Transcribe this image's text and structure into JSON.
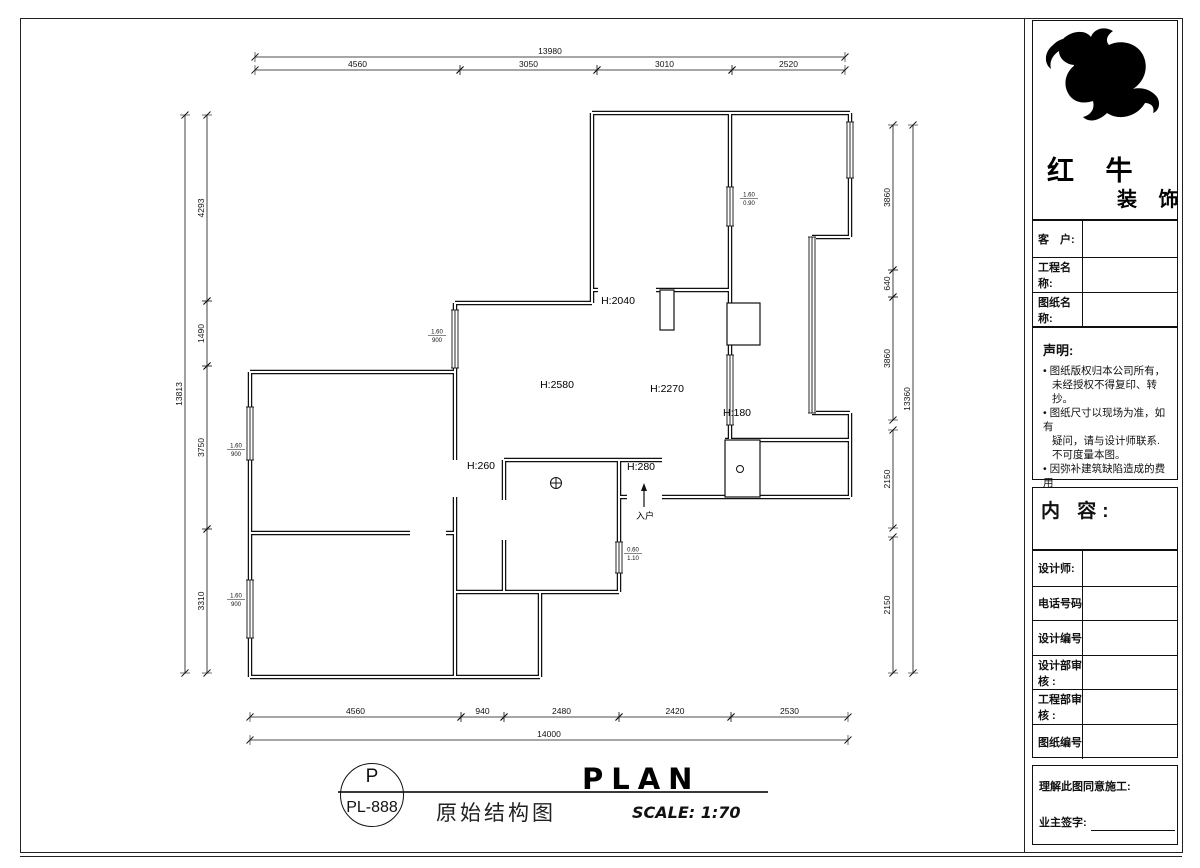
{
  "logo": {
    "name_top": "红 牛",
    "name_bottom": "装 饰"
  },
  "panel": {
    "info_rows": [
      {
        "label": "客　户:"
      },
      {
        "label": "工程名称:"
      },
      {
        "label": "图纸名称:"
      }
    ],
    "statement": {
      "title": "声明:",
      "lines": [
        {
          "bullet": true,
          "text": "图纸版权归本公司所有，"
        },
        {
          "bullet": false,
          "text": "未经授权不得复印、转抄。"
        },
        {
          "bullet": true,
          "text": "图纸尺寸以现场为准，如有"
        },
        {
          "bullet": false,
          "text": "疑问，请与设计师联系."
        },
        {
          "bullet": false,
          "text": "不可度量本图。"
        },
        {
          "bullet": true,
          "text": "因弥补建筑缺陷造成的费用"
        },
        {
          "bullet": false,
          "text": "增加与设计无关。"
        }
      ]
    },
    "content_label": "内 容:",
    "detail_rows": [
      {
        "label": "设计师:"
      },
      {
        "label": "电话号码"
      },
      {
        "label": "设计编号"
      },
      {
        "label": "设计部审核 :"
      },
      {
        "label": "工程部审核 :"
      },
      {
        "label": "图纸编号"
      }
    ],
    "sign": {
      "line1": "理解此图同意施工:",
      "line2": "业主签字:"
    }
  },
  "titlebar": {
    "circle_top": "P",
    "circle_bottom": "PL-888",
    "drawing_title": "原始结构图",
    "plan_word": "PLAN",
    "scale": "SCALE: 1:70"
  },
  "plan": {
    "room_labels": [
      {
        "text": "H:2040",
        "x": 618,
        "y": 304
      },
      {
        "text": "H:2580",
        "x": 557,
        "y": 388
      },
      {
        "text": "H:2270",
        "x": 667,
        "y": 392
      },
      {
        "text": "H:180",
        "x": 737,
        "y": 416
      },
      {
        "text": "H:260",
        "x": 481,
        "y": 469
      },
      {
        "text": "H:280",
        "x": 641,
        "y": 470
      }
    ],
    "window_tags": [
      {
        "top": "1.60",
        "bottom": "900",
        "x": 437,
        "y": 335
      },
      {
        "top": "1.60",
        "bottom": "0.90",
        "x": 749,
        "y": 198
      },
      {
        "top": "1.60",
        "bottom": "900",
        "x": 236,
        "y": 449
      },
      {
        "top": "1.60",
        "bottom": "900",
        "x": 236,
        "y": 599
      },
      {
        "top": "0.60",
        "bottom": "1.10",
        "x": 633,
        "y": 553
      }
    ],
    "entry": {
      "label": "入户",
      "x": 644,
      "y": 519
    },
    "dims": {
      "h": [
        {
          "label": "13980",
          "y": 57,
          "x1": 255,
          "x2": 845
        },
        {
          "label": "4560",
          "y": 70,
          "x1": 255,
          "x2": 460
        },
        {
          "label": "3050",
          "y": 70,
          "x1": 460,
          "x2": 597
        },
        {
          "label": "3010",
          "y": 70,
          "x1": 597,
          "x2": 732
        },
        {
          "label": "2520",
          "y": 70,
          "x1": 732,
          "x2": 845
        },
        {
          "label": "4560",
          "y": 717,
          "x1": 250,
          "x2": 461
        },
        {
          "label": "940",
          "y": 717,
          "x1": 461,
          "x2": 504
        },
        {
          "label": "2480",
          "y": 717,
          "x1": 504,
          "x2": 619
        },
        {
          "label": "2420",
          "y": 717,
          "x1": 619,
          "x2": 731
        },
        {
          "label": "2530",
          "y": 717,
          "x1": 731,
          "x2": 848
        },
        {
          "label": "14000",
          "y": 740,
          "x1": 250,
          "x2": 848
        }
      ],
      "v": [
        {
          "label": "13813",
          "x": 185,
          "y1": 115,
          "y2": 673
        },
        {
          "label": "4293",
          "x": 207,
          "y1": 115,
          "y2": 301
        },
        {
          "label": "1490",
          "x": 207,
          "y1": 301,
          "y2": 366
        },
        {
          "label": "3750",
          "x": 207,
          "y1": 366,
          "y2": 529
        },
        {
          "label": "3310",
          "x": 207,
          "y1": 529,
          "y2": 673
        },
        {
          "label": "3860",
          "x": 893,
          "y1": 125,
          "y2": 270
        },
        {
          "label": "640",
          "x": 893,
          "y1": 270,
          "y2": 297
        },
        {
          "label": "3860",
          "x": 893,
          "y1": 297,
          "y2": 420
        },
        {
          "label": "2150",
          "x": 893,
          "y1": 430,
          "y2": 528
        },
        {
          "label": "2150",
          "x": 893,
          "y1": 537,
          "y2": 673
        },
        {
          "label": "13360",
          "x": 913,
          "y1": 125,
          "y2": 673
        }
      ]
    }
  }
}
